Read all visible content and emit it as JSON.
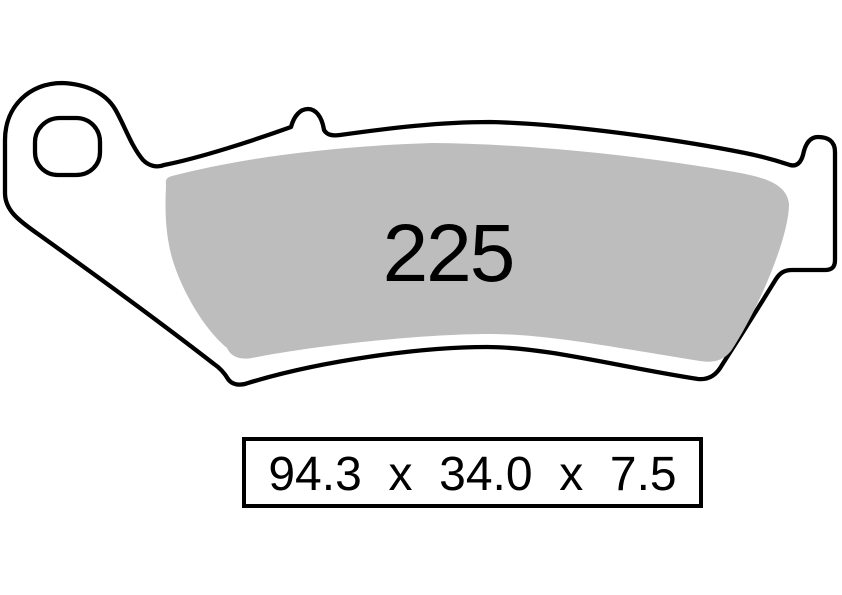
{
  "diagram": {
    "part_number": "225",
    "dimensions_label": "94.3  x  34.0  x  7.5",
    "dimensions": {
      "length_mm": "94.3",
      "height_mm": "34.0",
      "thickness_mm": "7.5",
      "separator": "x"
    },
    "colors": {
      "friction_material": "#bdbdbd",
      "outline": "#000000",
      "background": "#ffffff"
    }
  }
}
